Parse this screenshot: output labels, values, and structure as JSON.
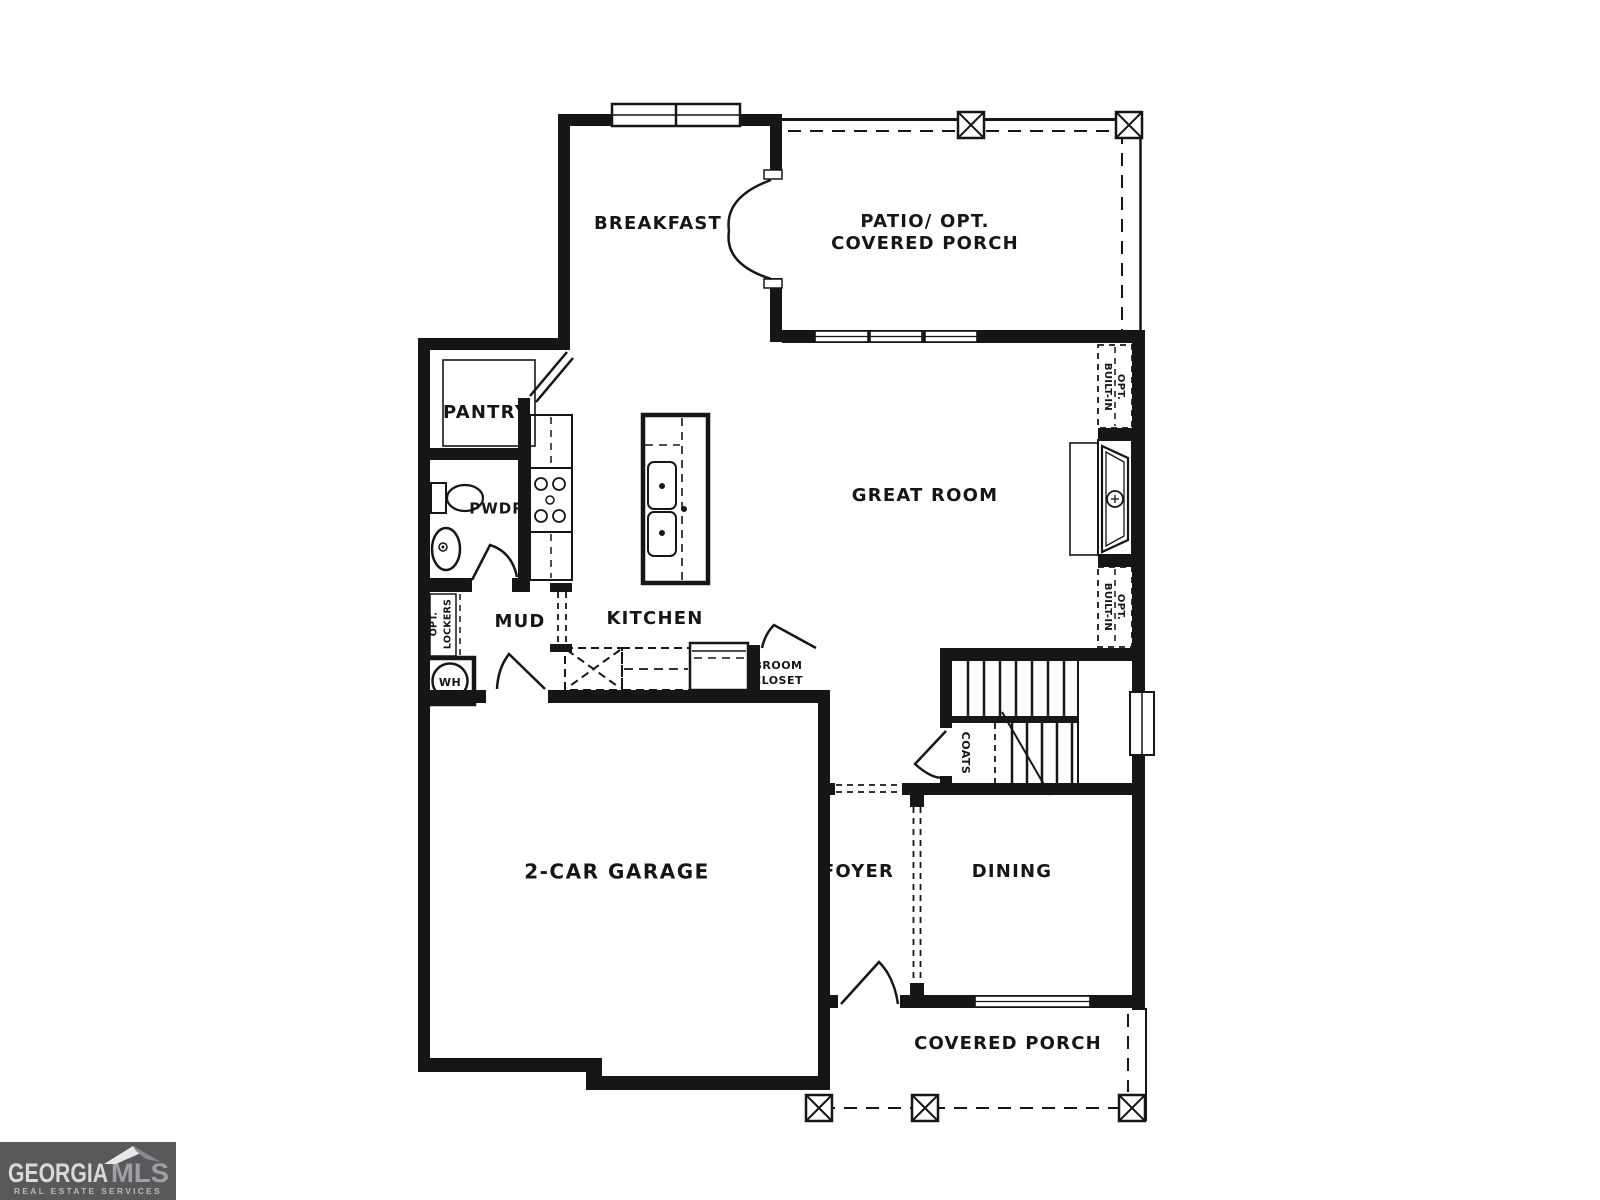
{
  "colors": {
    "wall": "#161616",
    "paper": "#ffffff",
    "logo_bg": "#59595c",
    "logo_text": "#d9d9da",
    "logo_mls": "#9fa0a3",
    "logo_tag": "#b9babd",
    "roof_light": "#e9e9ea",
    "roof_dark": "#8a8b8e"
  },
  "rooms": {
    "breakfast": {
      "label": "BREAKFAST"
    },
    "patio": {
      "label_line1": "PATIO/ OPT.",
      "label_line2": "COVERED PORCH"
    },
    "great_room": {
      "label": "GREAT ROOM"
    },
    "pantry": {
      "label": "PANTRY"
    },
    "powder": {
      "label": "PWDR"
    },
    "mud": {
      "label": "MUD"
    },
    "kitchen": {
      "label": "KITCHEN"
    },
    "garage": {
      "label": "2-CAR GARAGE"
    },
    "foyer": {
      "label": "FOYER"
    },
    "dining": {
      "label": "DINING"
    },
    "covered_porch": {
      "label": "COVERED PORCH"
    }
  },
  "closets": {
    "broom": {
      "line1": "BROOM",
      "line2": "CLOSET"
    },
    "coats": {
      "label": "COATS"
    },
    "lockers": {
      "line1": "OPT.",
      "line2": "LOCKERS"
    },
    "built_in_upper": {
      "line1": "OPT.",
      "line2": "BUILT-IN"
    },
    "built_in_lower": {
      "line1": "OPT.",
      "line2": "BUILT-IN"
    },
    "water_heater": {
      "label": "WH"
    }
  },
  "logo": {
    "brand": "GEORGIA",
    "brand_suffix": "MLS",
    "tagline": "REAL ESTATE SERVICES"
  }
}
